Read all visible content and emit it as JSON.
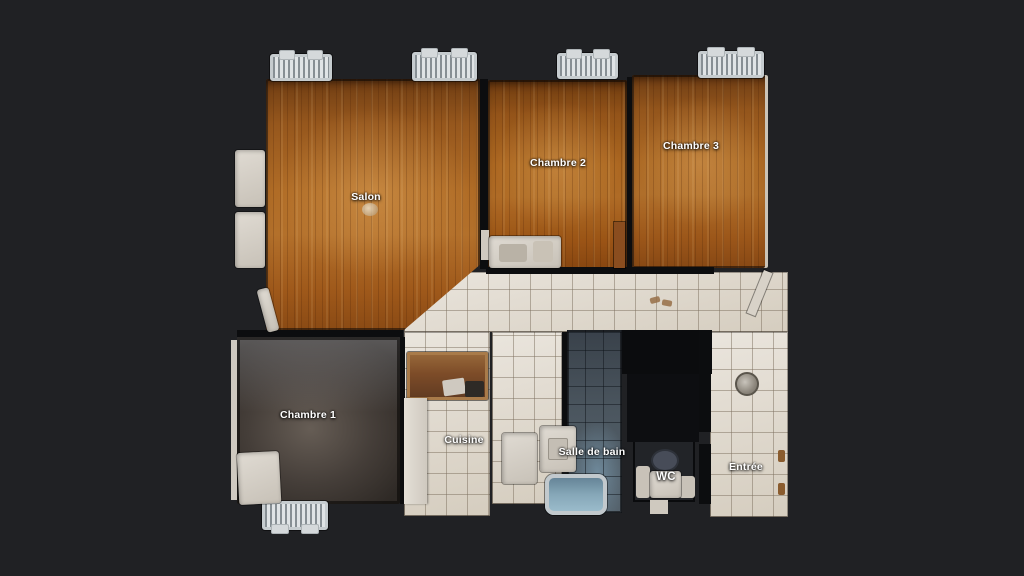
{
  "scene": {
    "type": "apartment-floor-plan-top-view"
  },
  "rooms": [
    {
      "id": "salon",
      "label": "Salon"
    },
    {
      "id": "chambre-2",
      "label": "Chambre 2"
    },
    {
      "id": "chambre-3",
      "label": "Chambre 3"
    },
    {
      "id": "chambre-1",
      "label": "Chambre 1"
    },
    {
      "id": "cuisine",
      "label": "Cuisine"
    },
    {
      "id": "salle-de-bain",
      "label": "Salle de bain"
    },
    {
      "id": "wc",
      "label": "WC"
    },
    {
      "id": "entree",
      "label": "Entrée"
    }
  ],
  "fixtures": [
    "radiator",
    "window-alcove",
    "wardrobe",
    "kitchen-counter",
    "kitchen-cabinet",
    "washing-machine",
    "washbasin",
    "bathtub",
    "toilet",
    "bed",
    "ceiling-light",
    "open-door",
    "door-hinge",
    "slippers",
    "round-rug"
  ],
  "colors": {
    "background": "#202124",
    "wood_floor": "#a96525",
    "dark_floor": "#49413b",
    "tile_floor": "#e2dcd2",
    "bath_tile": "#4c5862",
    "label_text": "#ffffff"
  }
}
